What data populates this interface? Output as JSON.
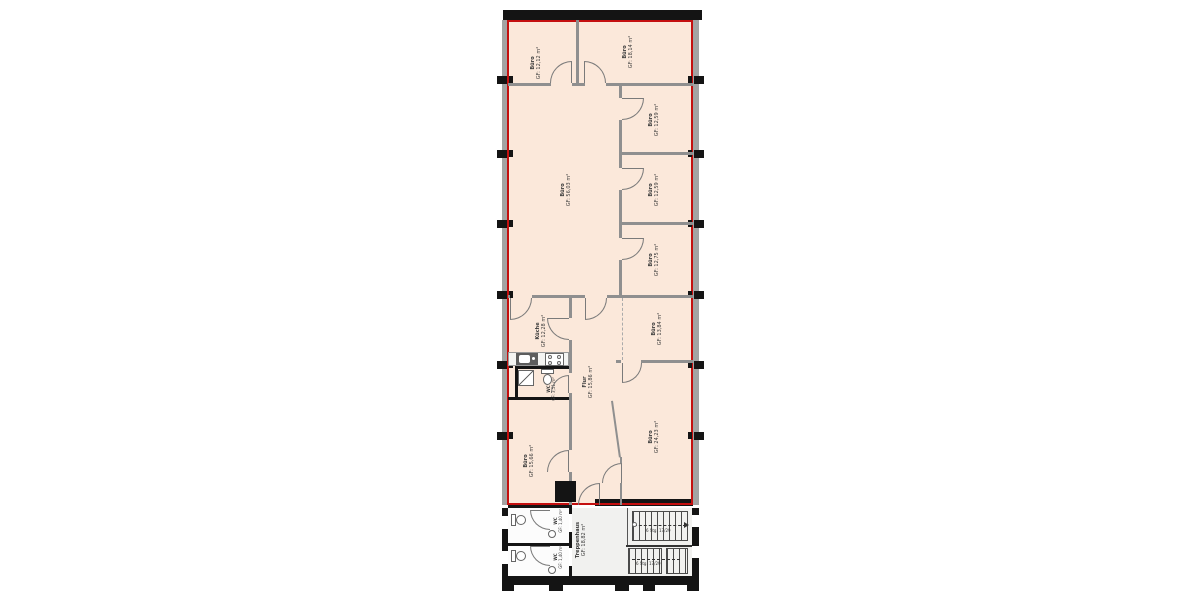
{
  "drawing": {
    "type": "floor-plan",
    "marked_color": "#c40f0f",
    "room_fill_color": "#fbe8da",
    "wall_gray_color": "#8f8f8f",
    "wall_black_color": "#141414"
  },
  "rooms": [
    {
      "id": "buero-top-left",
      "name": "Büro",
      "area": "GF: 12,12 m²"
    },
    {
      "id": "buero-top-right",
      "name": "Büro",
      "area": "GF: 18,14 m²"
    },
    {
      "id": "buero-large",
      "name": "Büro",
      "area": "GF: 56,03 m²"
    },
    {
      "id": "buero-right-1",
      "name": "Büro",
      "area": "GF: 12,59 m²"
    },
    {
      "id": "buero-right-2",
      "name": "Büro",
      "area": "GF: 12,59 m²"
    },
    {
      "id": "buero-right-3",
      "name": "Büro",
      "area": "GF: 12,75 m²"
    },
    {
      "id": "kueche",
      "name": "Küche",
      "area": "GF: 12,28 m²"
    },
    {
      "id": "wc-klein",
      "name": "WC",
      "area": "GF: 3,51 m²"
    },
    {
      "id": "flur",
      "name": "Flur",
      "area": "GF: 15,86 m²"
    },
    {
      "id": "buero-mid-right",
      "name": "Büro",
      "area": "GF: 13,84 m²"
    },
    {
      "id": "buero-bottom-left",
      "name": "Büro",
      "area": "GF: 15,66 m²"
    },
    {
      "id": "buero-bottom-right",
      "name": "Büro",
      "area": "GF: 24,23 m²"
    },
    {
      "id": "treppenhaus",
      "name": "Treppenhaus",
      "area": "GF: 18,82 m²"
    },
    {
      "id": "wc-1",
      "name": "WC",
      "area": "GF: 1,40 m²"
    },
    {
      "id": "wc-2",
      "name": "WC",
      "area": "GF: 1,40 m²"
    }
  ],
  "stairs": {
    "flight_up_label": "6 Stg. 17/29",
    "flight_down_label": "6 Stg. 17/29"
  }
}
